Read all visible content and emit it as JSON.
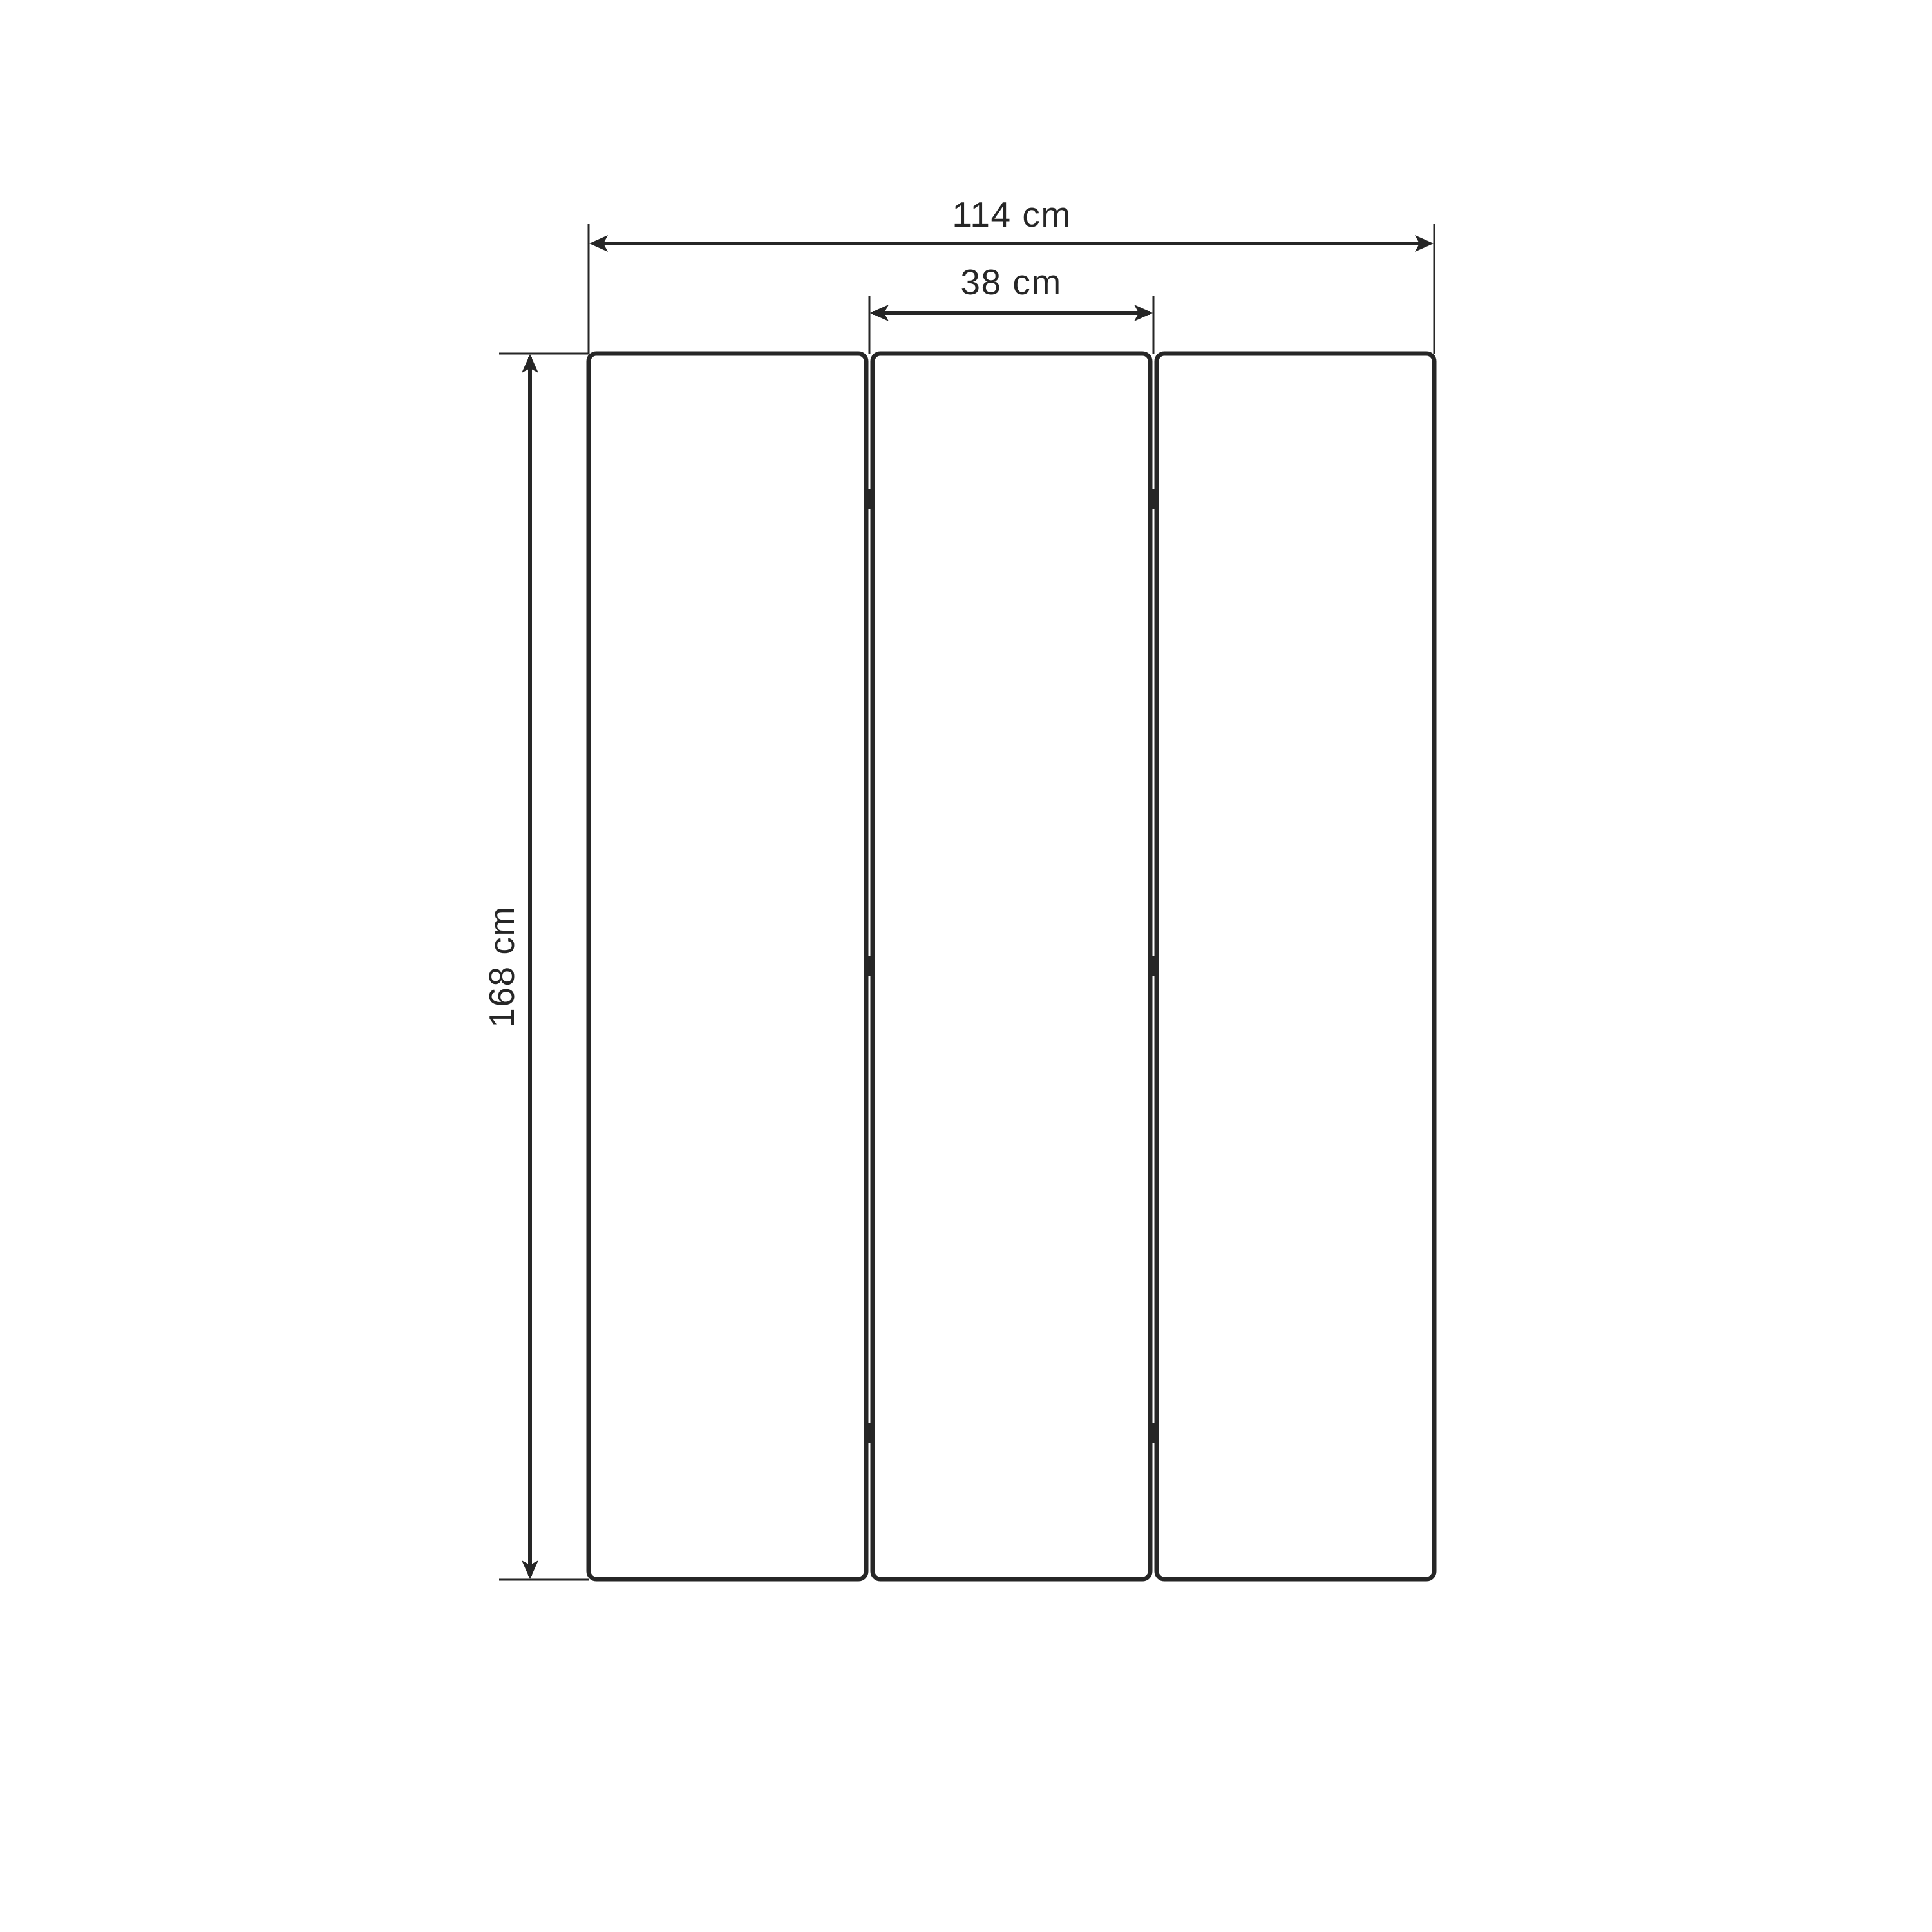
{
  "diagram": {
    "type": "furniture-dimension-drawing",
    "subject": "three-panel folding screen, front view",
    "panel_count": 3,
    "hinge_rows": 3,
    "dimensions": {
      "total_width": {
        "value": 114,
        "unit": "cm",
        "label": "114 cm"
      },
      "panel_width": {
        "value": 38,
        "unit": "cm",
        "label": "38 cm"
      },
      "height": {
        "value": 168,
        "unit": "cm",
        "label": "168 cm"
      }
    },
    "colors": {
      "line": "#262626",
      "bg": "#ffffff"
    }
  }
}
